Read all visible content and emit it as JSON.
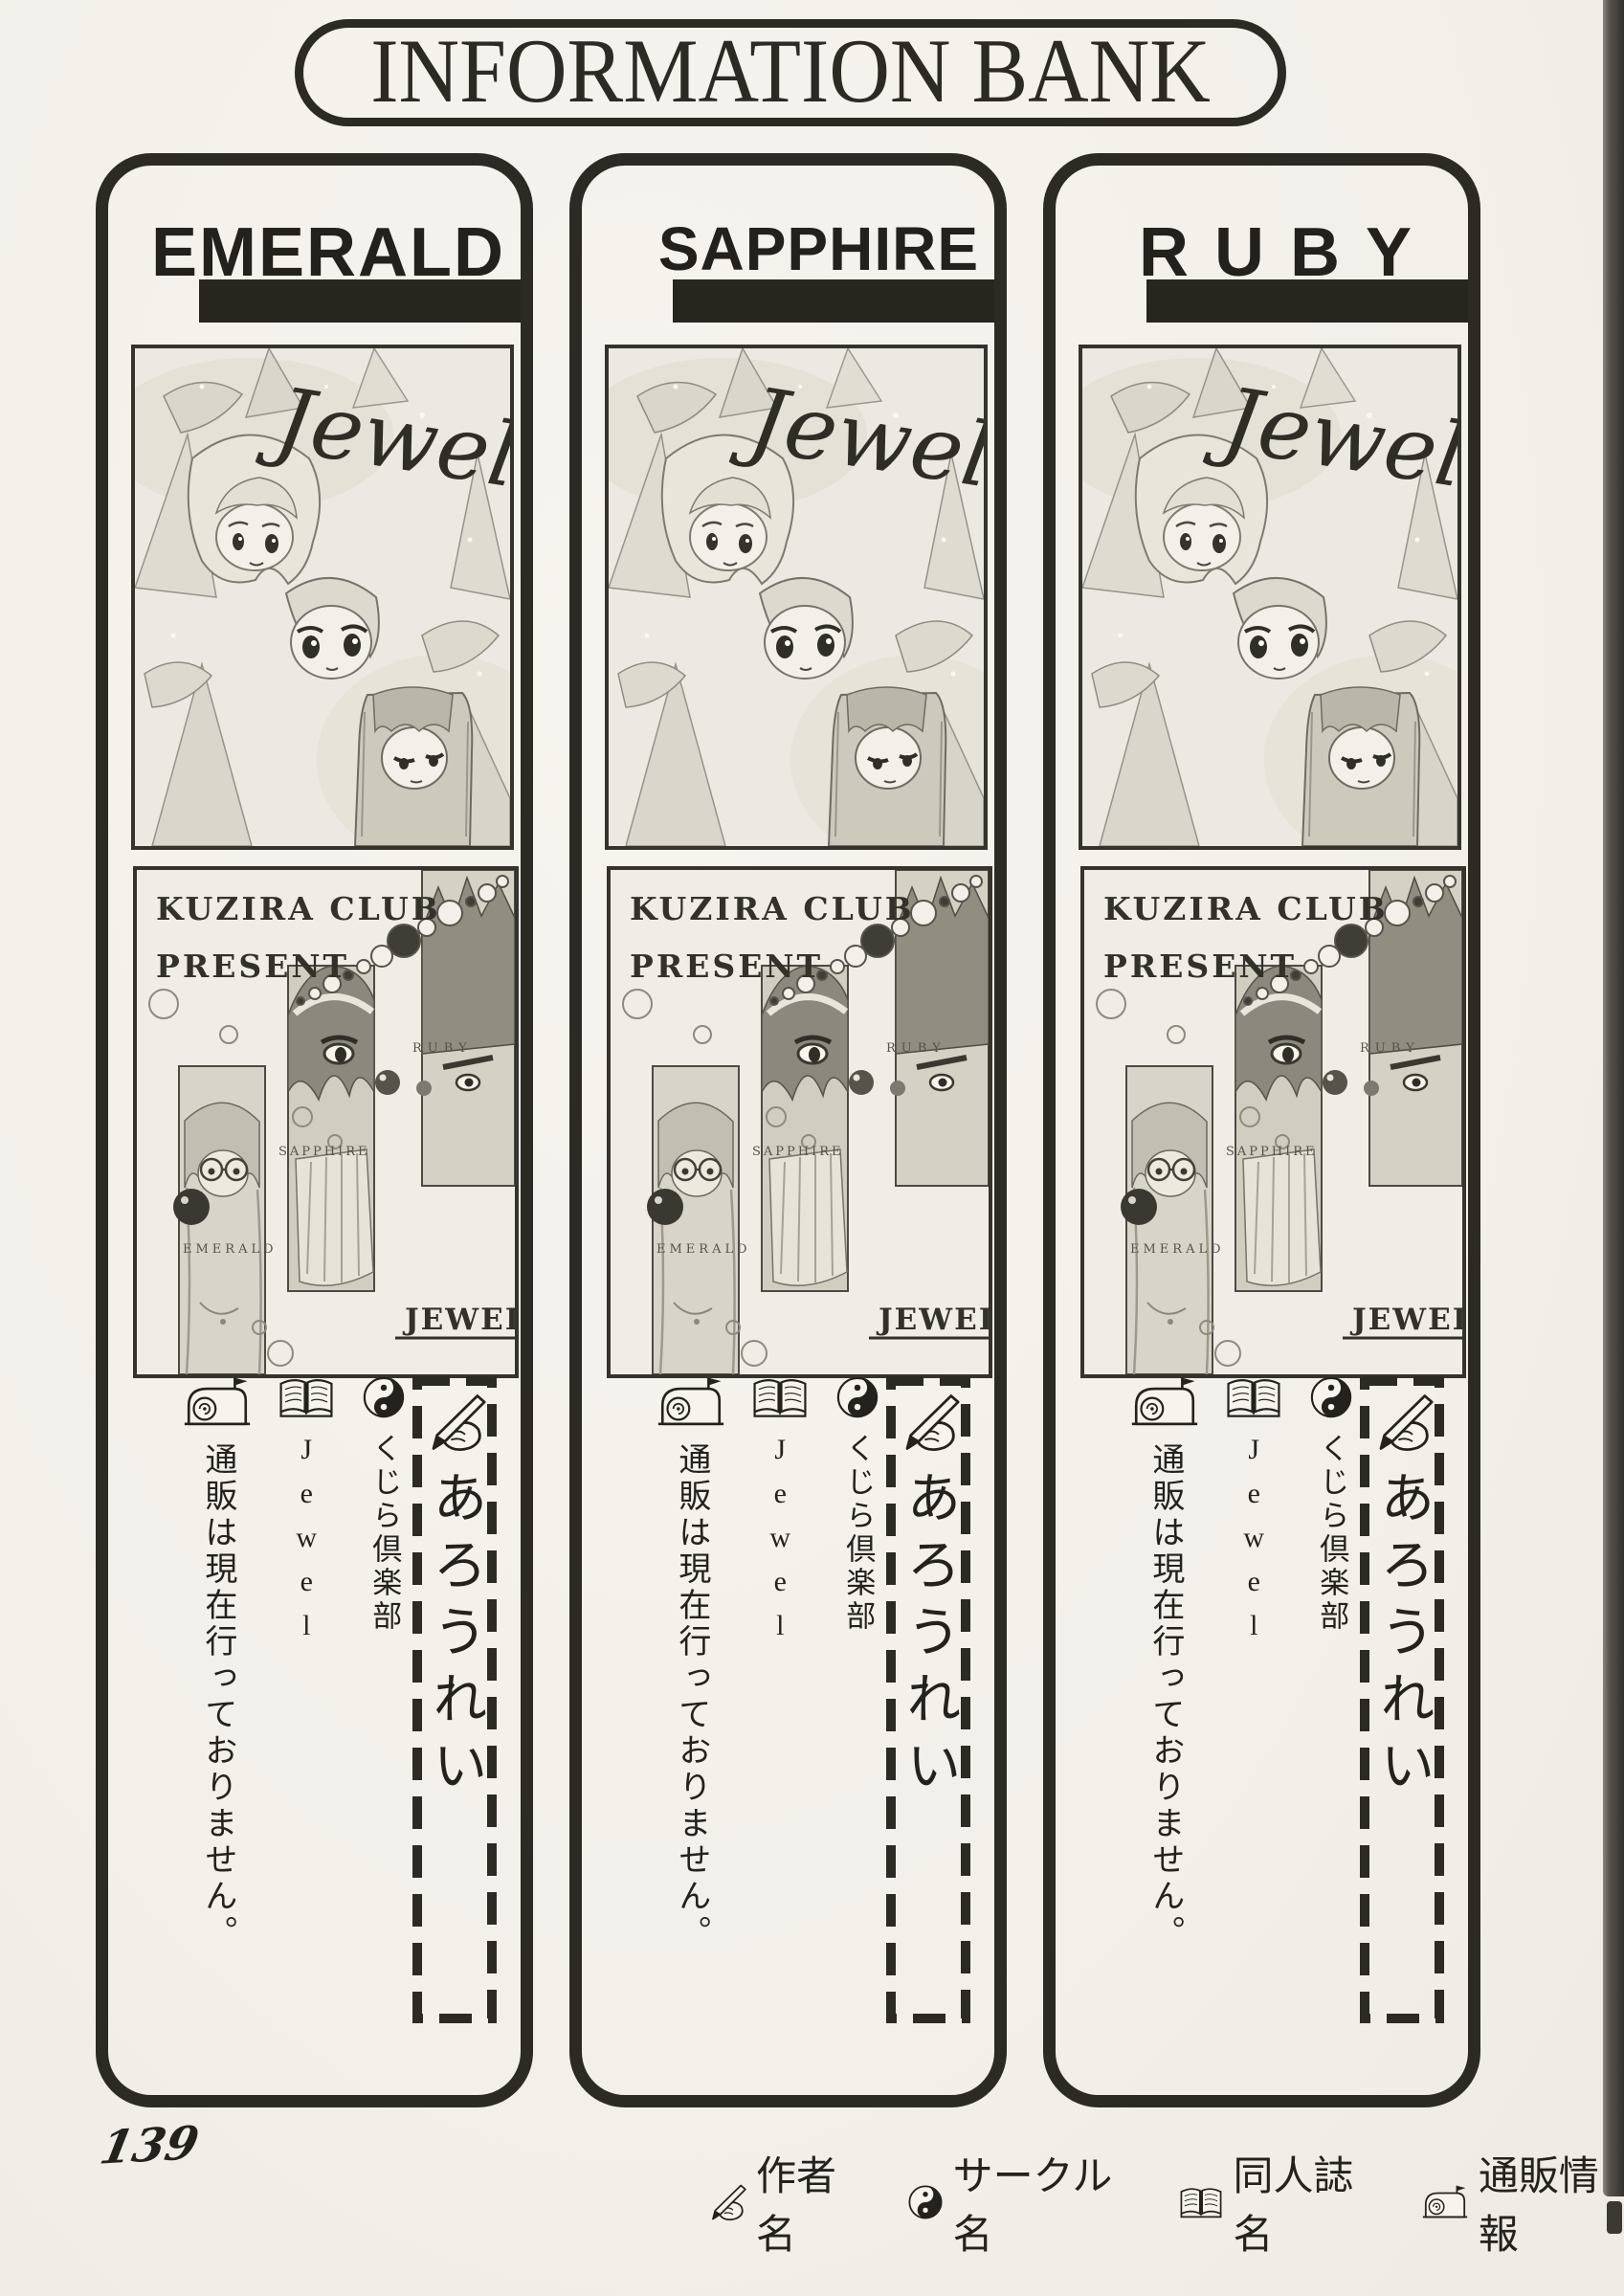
{
  "page": {
    "title": "INFORMATION BANK",
    "page_number": "139"
  },
  "columns": [
    {
      "title": "EMERALD"
    },
    {
      "title": "SAPPHIRE"
    },
    {
      "title": "RUBY"
    }
  ],
  "covers": {
    "jewel": {
      "title": "Jewel"
    },
    "kuzira": {
      "publisher_line1": "KUZIRA CLUB",
      "publisher_line2": "PRESENT",
      "label_emerald": "EMERALD",
      "label_sapphire": "SAPPHIRE",
      "label_ruby": "RUBY",
      "title": "JEWEL"
    }
  },
  "entry": {
    "author_name": "あろうれい",
    "circle_name": "くじら倶楽部",
    "book_title": "Jewel",
    "mailorder_info": "通販は現在行っておりません。"
  },
  "legend": {
    "author_label": "作者名",
    "circle_label": "サークル名",
    "book_label": "同人誌名",
    "mailorder_label": "通販情報"
  },
  "colors": {
    "ink": "#2b2a23",
    "paper": "#f2f0e9"
  }
}
